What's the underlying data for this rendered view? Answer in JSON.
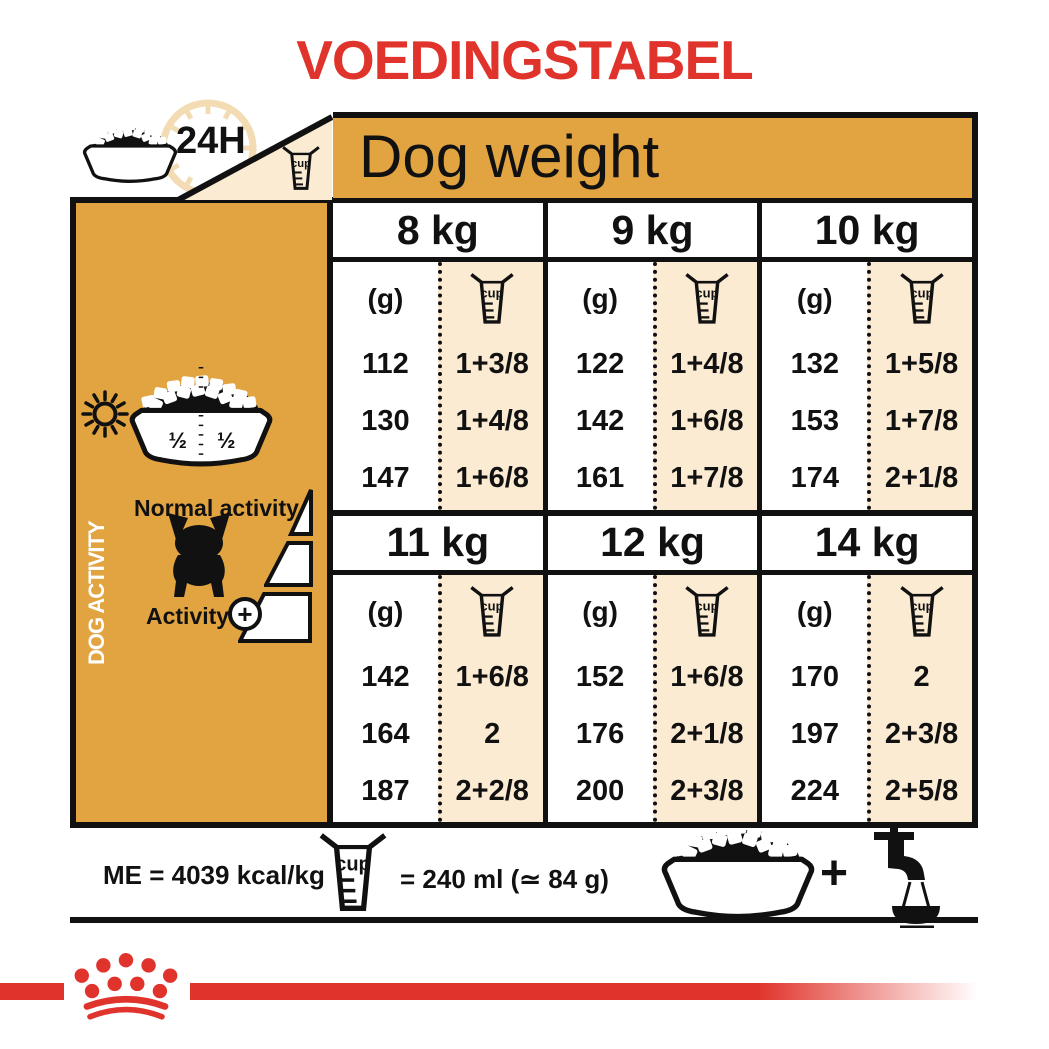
{
  "title": "VOEDINGSTABEL",
  "header": {
    "hours": "24H",
    "dog_weight": "Dog weight"
  },
  "labels": {
    "cup": "cup"
  },
  "sidebar": {
    "vertical_label": "DOG ACTIVITY",
    "half_left": "½",
    "half_right": "½",
    "normal_activity": "Normal activity",
    "activity": "Activity",
    "plus": "+"
  },
  "table": {
    "grams_header": "(g)",
    "groups": [
      {
        "columns": [
          {
            "weight": "8 kg",
            "grams": [
              "112",
              "130",
              "147"
            ],
            "cups": [
              "1+3/8",
              "1+4/8",
              "1+6/8"
            ]
          },
          {
            "weight": "9 kg",
            "grams": [
              "122",
              "142",
              "161"
            ],
            "cups": [
              "1+4/8",
              "1+6/8",
              "1+7/8"
            ]
          },
          {
            "weight": "10 kg",
            "grams": [
              "132",
              "153",
              "174"
            ],
            "cups": [
              "1+5/8",
              "1+7/8",
              "2+1/8"
            ]
          }
        ]
      },
      {
        "columns": [
          {
            "weight": "11 kg",
            "grams": [
              "142",
              "164",
              "187"
            ],
            "cups": [
              "1+6/8",
              "2",
              "2+2/8"
            ]
          },
          {
            "weight": "12 kg",
            "grams": [
              "152",
              "176",
              "200"
            ],
            "cups": [
              "1+6/8",
              "2+1/8",
              "2+3/8"
            ]
          },
          {
            "weight": "14 kg",
            "grams": [
              "170",
              "197",
              "224"
            ],
            "cups": [
              "2",
              "2+3/8",
              "2+5/8"
            ]
          }
        ]
      }
    ]
  },
  "footer": {
    "me": "ME = 4039 kcal/kg",
    "cup_equiv": "= 240 ml (≃ 84 g)",
    "plus": "+"
  },
  "colors": {
    "orange": "#E2A440",
    "cream": "#FBEBD2",
    "red": "#E0332B",
    "black": "#111111"
  }
}
